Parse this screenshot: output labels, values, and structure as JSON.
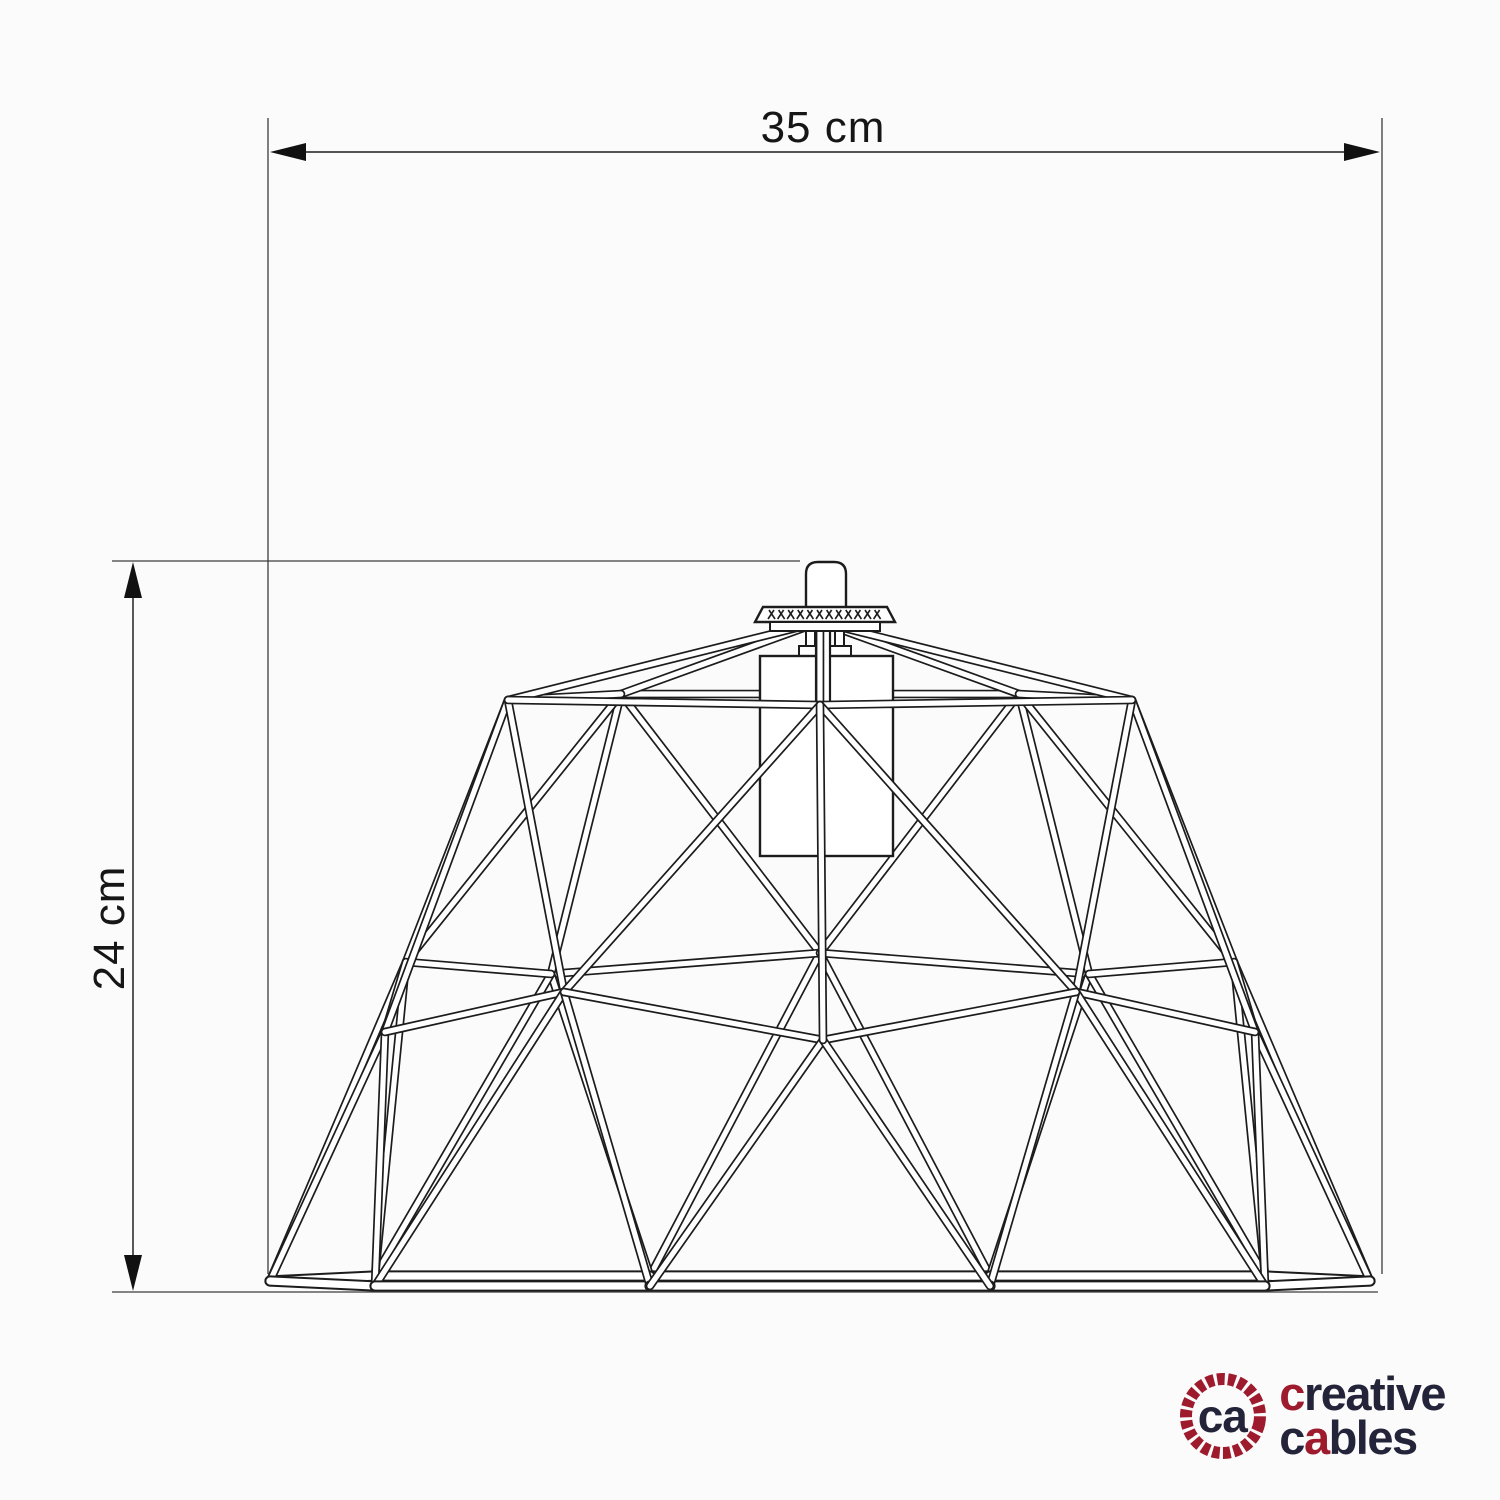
{
  "drawing": {
    "background": "#fbfbfb",
    "stroke_color": "#1c1c1c",
    "tube_fill": "#ffffff",
    "dim_line_color": "#3c3c3c",
    "width_dimension": {
      "label": "35 cm"
    },
    "height_dimension": {
      "label": "24 cm"
    }
  },
  "logo": {
    "monogram": "ca",
    "line1_first": "c",
    "line1_rest": "reative",
    "line2_first": "c",
    "line2_red": "a",
    "line2_rest": "bles",
    "red": "#9e1b2d",
    "dark": "#23243a"
  }
}
